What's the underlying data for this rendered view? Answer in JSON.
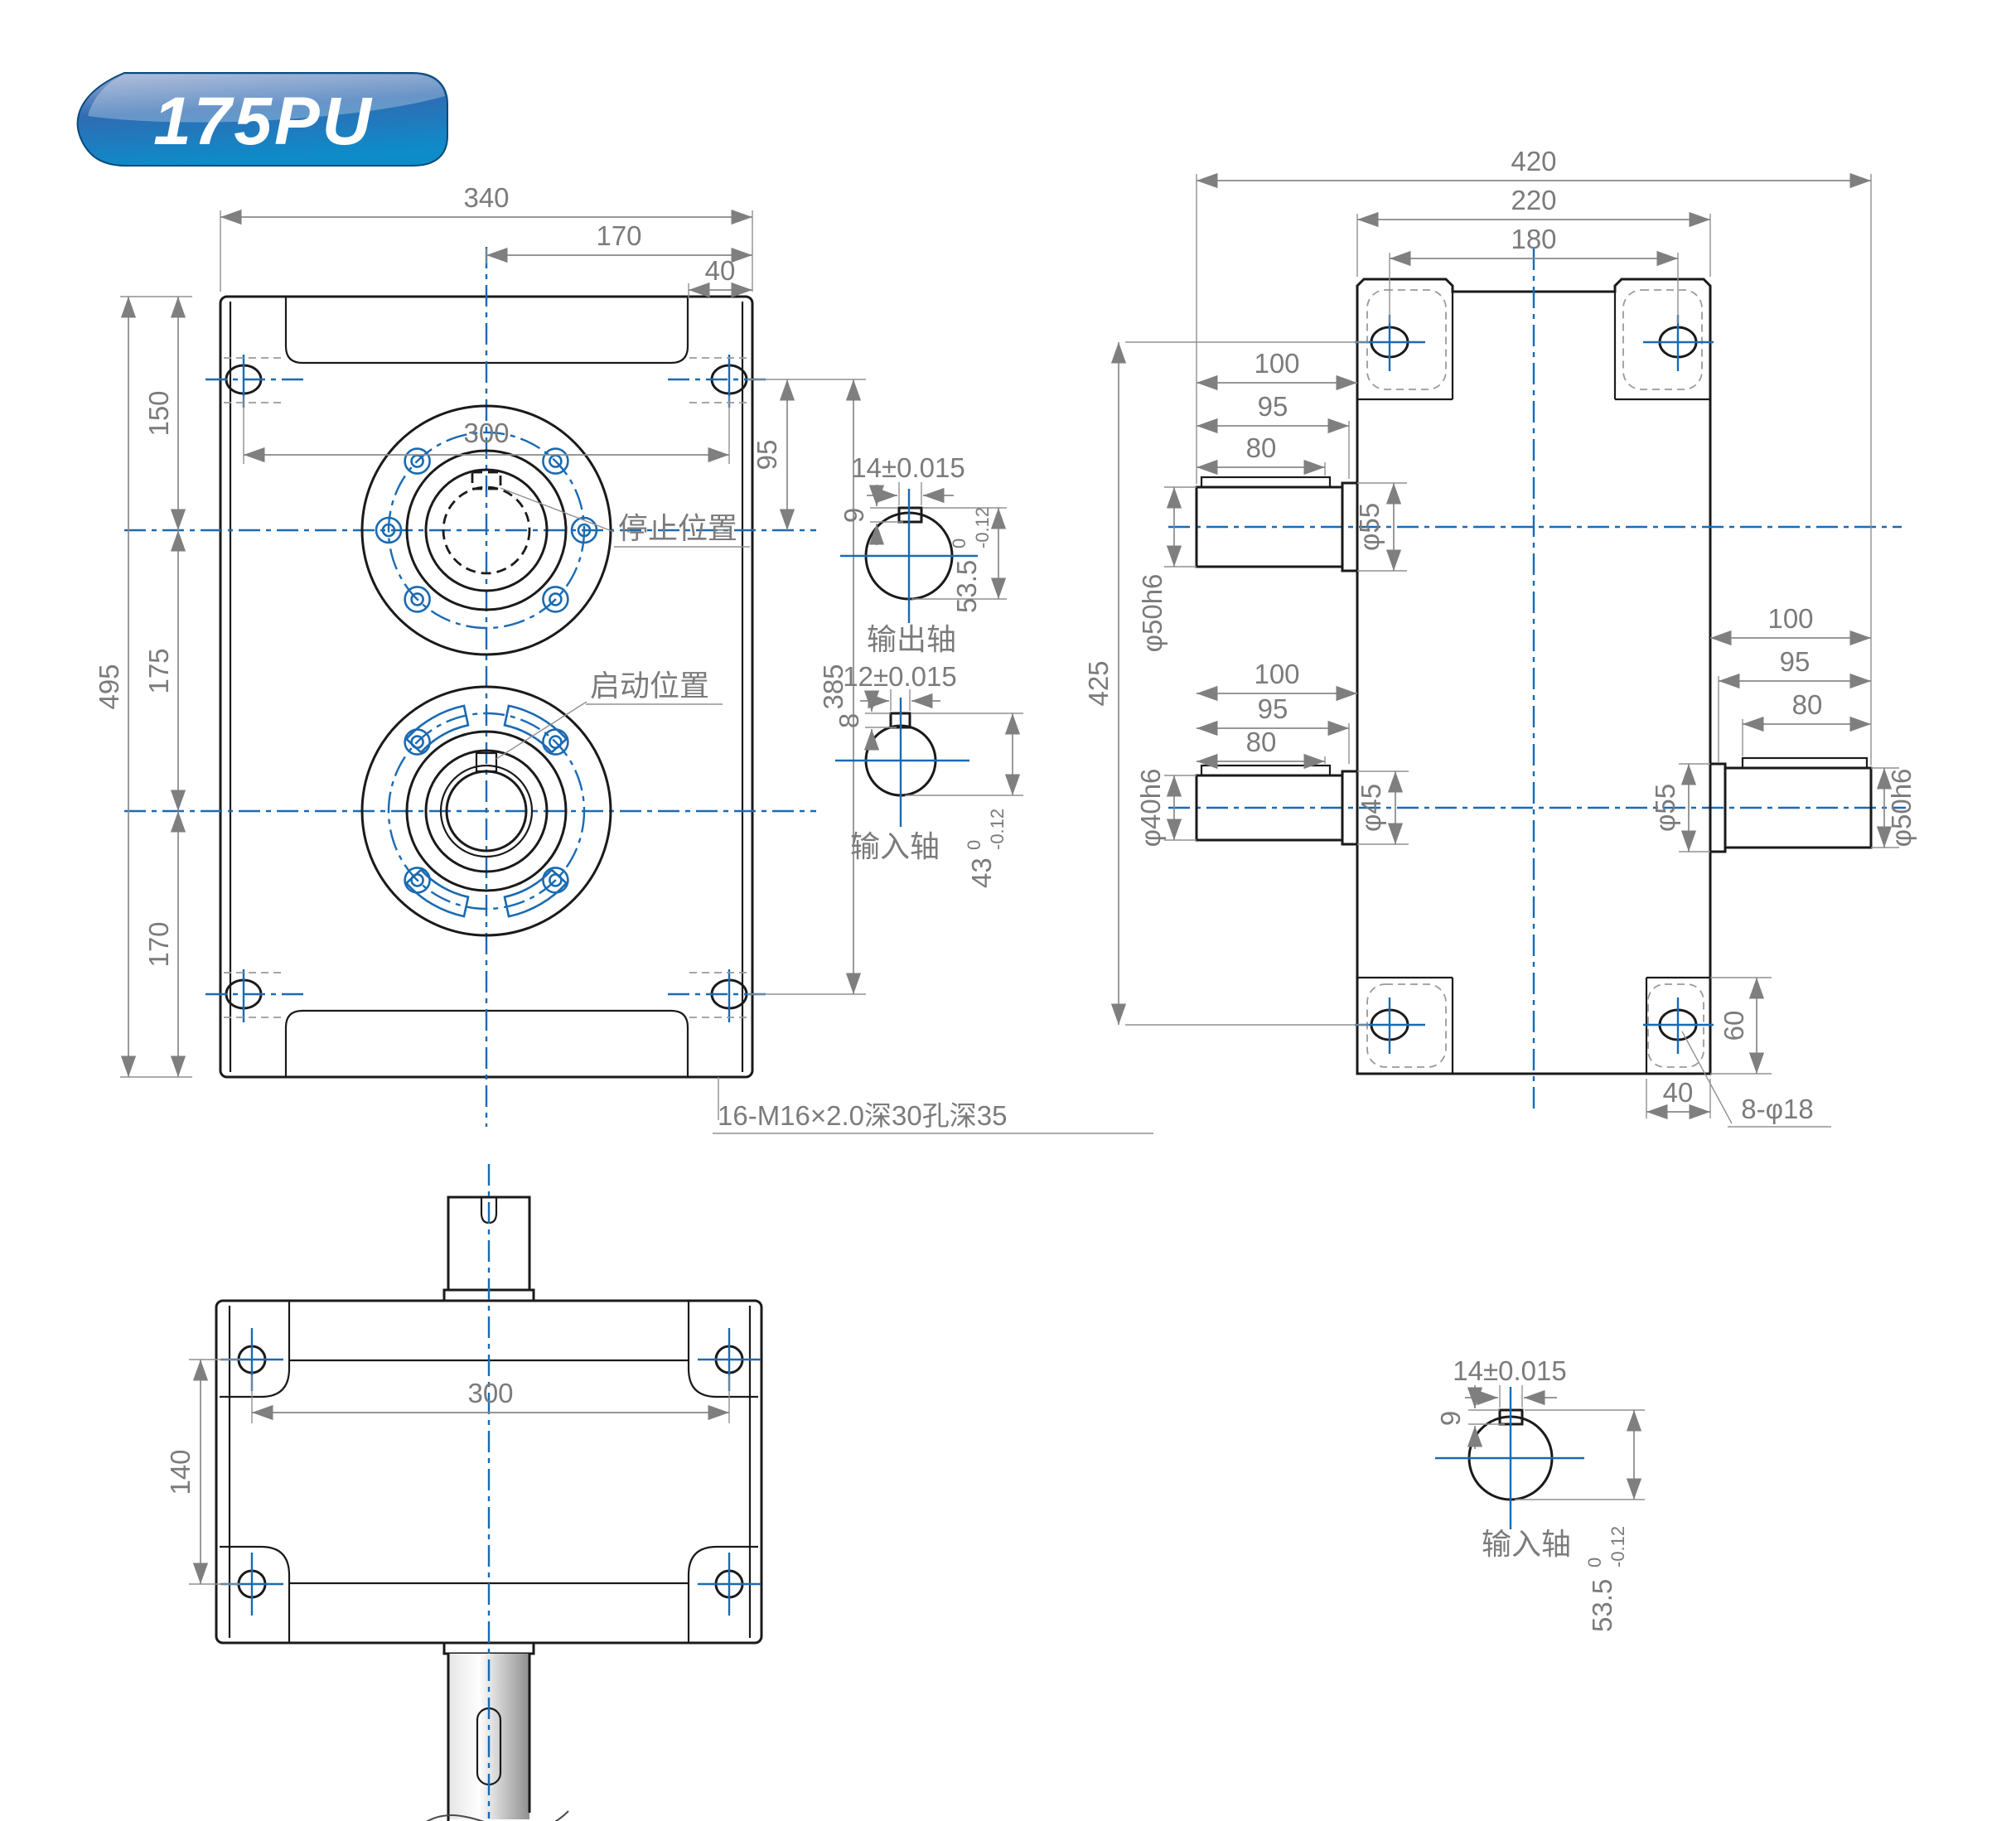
{
  "badge": {
    "model": "175PU",
    "color_top": "#97a8d0",
    "color_mid": "#2f6cb3",
    "color_bottom": "#0d8cc9"
  },
  "colors": {
    "centerline": "#1a6ab2",
    "dimension_text": "#7b7b7b",
    "outline": "#1a1a1a",
    "body_fill": "#dce8f4"
  },
  "front_view": {
    "dim_width_total": "340",
    "dim_width_half": "170",
    "dim_tab": "40",
    "dim_hole_span": "300",
    "dim_height_total": "495",
    "dim_top_to_output": "150",
    "dim_output_to_input": "175",
    "dim_input_to_bottom": "170",
    "dim_hole_to_output": "95",
    "dim_hole_span_v": "385",
    "label_stop_position": "停止位置",
    "label_start_position": "启动位置",
    "note_mounting": "16-M16×2.0深30孔深35"
  },
  "output_shaft_section": {
    "label": "输出轴",
    "key_width": "14±0.015",
    "key_height": "9",
    "across_flat": "53.5",
    "tol_upper": "0",
    "tol_lower": "-0.12"
  },
  "input_shaft_section": {
    "label": "输入轴",
    "key_width": "12±0.015",
    "key_height": "8",
    "across_flat": "43",
    "tol_upper": "0",
    "tol_lower": "-0.12"
  },
  "side_view": {
    "dim_width_total": "420",
    "dim_body_width": "220",
    "dim_hole_span": "180",
    "dim_hole_span_v": "425",
    "upper_shaft": {
      "dim_100": "100",
      "dim_95": "95",
      "dim_80": "80",
      "dia_shaft": "φ50h6",
      "dia_boss": "φ55"
    },
    "lower_shaft": {
      "dim_100": "100",
      "dim_95": "95",
      "dim_80": "80",
      "dia_shaft": "φ40h6",
      "dia_boss": "φ45"
    },
    "right_shaft": {
      "dim_100": "100",
      "dim_95": "95",
      "dim_80": "80",
      "dia_shaft": "φ50h6",
      "dia_boss": "φ55"
    },
    "dim_foot_height": "60",
    "dim_foot_width": "40",
    "note_holes": "8-φ18"
  },
  "bottom_view": {
    "dim_hole_span": "300",
    "dim_hole_span_v": "140"
  },
  "bottom_shaft_section": {
    "label": "输入轴",
    "key_width": "14±0.015",
    "key_height": "9",
    "across_flat": "53.5",
    "tol_upper": "0",
    "tol_lower": "-0.12"
  }
}
